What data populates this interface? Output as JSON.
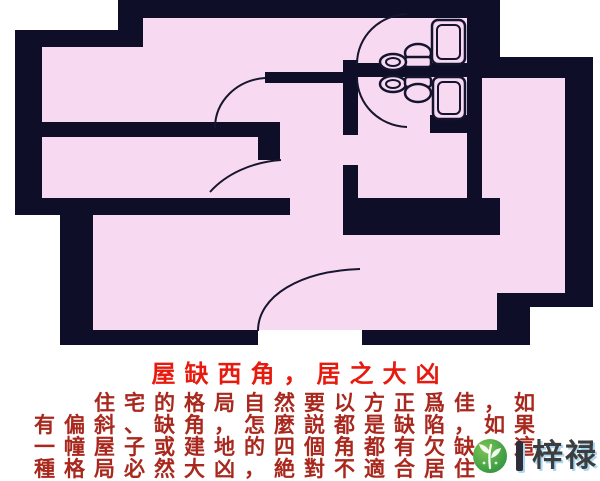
{
  "floor_plan": {
    "type": "apartment-floorplan-missing-west-corner",
    "wall_color": "#0e0e28",
    "room_fill": "#f8d9f2",
    "line_color": "#14142e",
    "rooms": [
      "top-left-room",
      "middle-left-room",
      "hallway",
      "upper-bathroom",
      "lower-bathroom",
      "right-room",
      "lower-room"
    ],
    "fixtures": [
      "bathtub-upper",
      "toilet-upper",
      "sink-upper",
      "bathtub-lower",
      "toilet-lower",
      "sink-lower"
    ],
    "door_arcs": 5
  },
  "caption": {
    "title": "屋缺西角，居之大凶",
    "title_color": "#e8190d",
    "body_color": "#a8281e",
    "lines": [
      "　　住宅的格局自然要以方正爲佳，如",
      "有偏斜、缺角，怎麼説都是缺陷，如果",
      "一幢屋子或建地的四個角都有欠缺，這",
      "種格局必然大凶，絶對不適合居住"
    ]
  },
  "watermark": {
    "logo": "leaf-logo",
    "logo_color": "#2f9440",
    "separator_bar": "",
    "text": "梓禄",
    "text_color": "#3d3d3d",
    "shadow_color": "#a9d9f2"
  }
}
